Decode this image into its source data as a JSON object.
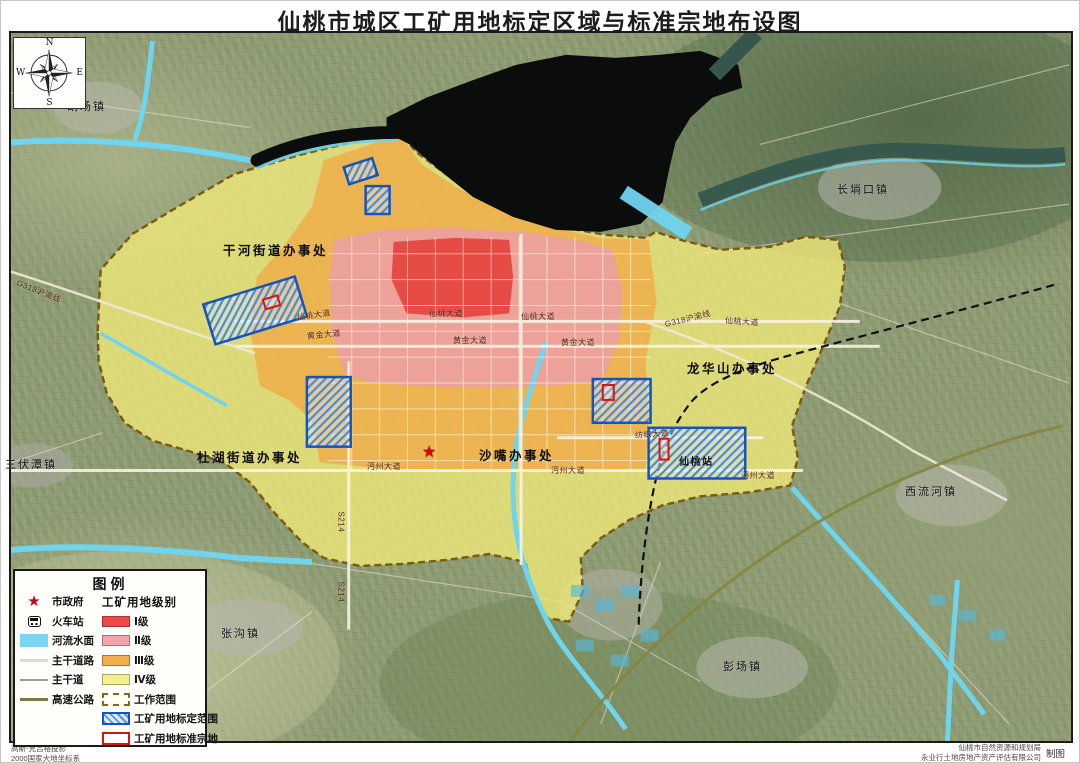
{
  "title": "仙桃市城区工矿用地标定区域与标准宗地布设图",
  "compass": {
    "n": "N",
    "e": "E",
    "s": "S",
    "w": "W"
  },
  "legend": {
    "title": "图例",
    "right_header": "工矿用地级别",
    "left_items": [
      {
        "icon": "star",
        "label": "市政府"
      },
      {
        "icon": "train",
        "label": "火车站"
      },
      {
        "icon": "water",
        "label": "河流水面"
      },
      {
        "icon": "road-light",
        "label": "主干道路"
      },
      {
        "icon": "road-gray",
        "label": "主干道"
      },
      {
        "icon": "highway",
        "label": "高速公路"
      }
    ],
    "grade_items": [
      {
        "label": "Ⅰ级",
        "color": "#ee4a47"
      },
      {
        "label": "Ⅱ级",
        "color": "#f2a3ab"
      },
      {
        "label": "Ⅲ级",
        "color": "#f0ae4c"
      },
      {
        "label": "Ⅳ级",
        "color": "#f5ee8e"
      }
    ],
    "extra_items": [
      {
        "type": "work-scope",
        "label": "工作范围"
      },
      {
        "type": "demarcation",
        "label": "工矿用地标定范围"
      },
      {
        "type": "parcel",
        "label": "工矿用地标准宗地"
      }
    ]
  },
  "markers": {
    "city_government": {
      "symbol": "★",
      "x": 421,
      "y": 444
    }
  },
  "map_labels": {
    "towns": [
      {
        "text": "胡场镇",
        "x": 66,
        "y": 97
      },
      {
        "text": "长埫口镇",
        "x": 836,
        "y": 180
      },
      {
        "text": "三伏潭镇",
        "x": 4,
        "y": 455
      },
      {
        "text": "张沟镇",
        "x": 220,
        "y": 624
      },
      {
        "text": "西流河镇",
        "x": 904,
        "y": 482
      },
      {
        "text": "彭场镇",
        "x": 722,
        "y": 657
      }
    ],
    "districts": [
      {
        "text": "干河街道办事处",
        "x": 222,
        "y": 239
      },
      {
        "text": "龙华山办事处",
        "x": 686,
        "y": 357
      },
      {
        "text": "杜湖街道办事处",
        "x": 196,
        "y": 446
      },
      {
        "text": "沙嘴办事处",
        "x": 478,
        "y": 444
      }
    ],
    "roads": [
      {
        "text": "G318沪渝线",
        "x": 16,
        "y": 276,
        "rot": 22
      },
      {
        "text": "G318沪渝线",
        "x": 664,
        "y": 318,
        "rot": -14
      },
      {
        "text": "仙桃大道",
        "x": 296,
        "y": 311,
        "rot": -8
      },
      {
        "text": "仙桃大道",
        "x": 428,
        "y": 307,
        "rot": 0
      },
      {
        "text": "仙桃大道",
        "x": 520,
        "y": 310,
        "rot": 0
      },
      {
        "text": "仙桃大道",
        "x": 724,
        "y": 314,
        "rot": 4
      },
      {
        "text": "黄金大道",
        "x": 306,
        "y": 330,
        "rot": -6
      },
      {
        "text": "黄金大道",
        "x": 452,
        "y": 334,
        "rot": 0
      },
      {
        "text": "黄金大道",
        "x": 560,
        "y": 336,
        "rot": 0
      },
      {
        "text": "沔州大道",
        "x": 366,
        "y": 460,
        "rot": 0
      },
      {
        "text": "沔州大道",
        "x": 550,
        "y": 464,
        "rot": 0
      },
      {
        "text": "沔州大道",
        "x": 740,
        "y": 469,
        "rot": 0
      },
      {
        "text": "纺织大道",
        "x": 634,
        "y": 429,
        "rot": -4
      },
      {
        "text": "S214",
        "x": 340,
        "y": 506,
        "rot": 90
      },
      {
        "text": "S214",
        "x": 340,
        "y": 576,
        "rot": 90
      }
    ],
    "station": {
      "text": "仙桃站",
      "x": 678,
      "y": 452,
      "rot": 0
    }
  },
  "footnotes": {
    "left1": "高斯-克吕格投影",
    "left2": "2000国家大地坐标系",
    "right1": "仙桃市自然资源和规划局",
    "right2": "永业行土地房地产资产评估有限公司",
    "credit": "制图"
  }
}
